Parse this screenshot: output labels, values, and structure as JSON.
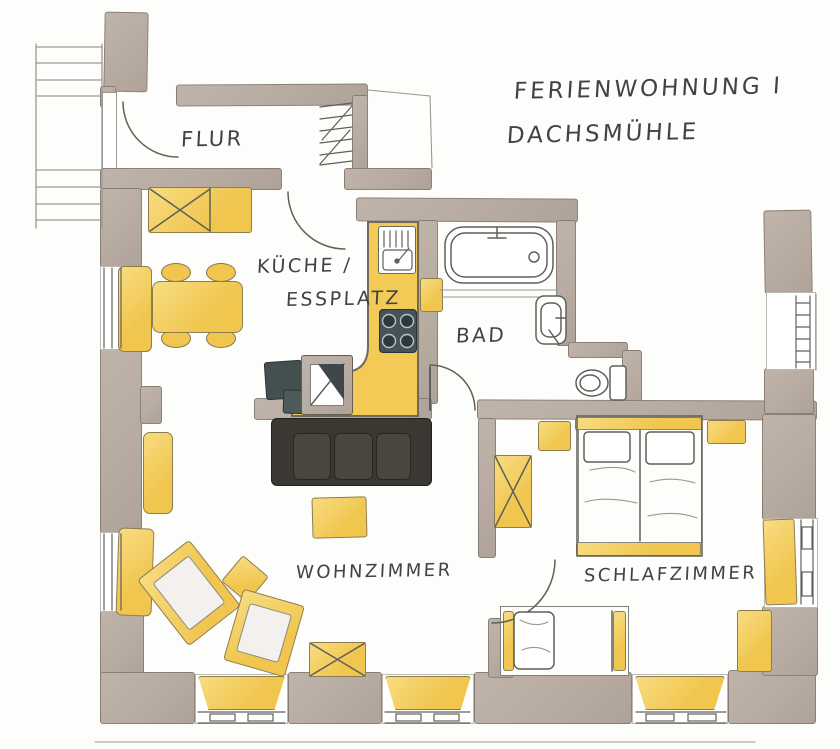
{
  "title": {
    "line1": "FERIENWOHNUNG I",
    "line2": "DACHSMÜHLE"
  },
  "rooms": {
    "flur": {
      "label": "FLUR"
    },
    "kueche": {
      "label_line1": "KÜCHE /",
      "label_line2": "ESSPLATZ"
    },
    "bad": {
      "label": "BAD"
    },
    "wohnzimmer": {
      "label": "WOHNZIMMER"
    },
    "schlafzimmer": {
      "label": "SCHLAFZIMMER"
    }
  },
  "legend_items": [],
  "furniture_names": [
    "hall-wardrobe",
    "dining-bench",
    "dining-table",
    "dining-chairs",
    "kitchen-counter",
    "kitchen-sink",
    "stove",
    "chimney",
    "tv-unit",
    "sofa",
    "coffee-table",
    "armchairs",
    "side-table",
    "cross-table",
    "double-bed",
    "single-bed",
    "bedroom-wardrobe",
    "nightstands",
    "bathtub",
    "washbasin",
    "toilet",
    "radiators",
    "windows",
    "stairs"
  ],
  "colors": {
    "paper": "#fdfdfb",
    "wall": "#b8aba1",
    "wall_edge": "#6e645b",
    "pencil": "#60605a",
    "pencil_light": "#9b988f",
    "yellow": "#f0c64f",
    "yellow_light": "#f8dc82",
    "sofa_dark": "#3b3833",
    "sofa_cushion": "#4a453d",
    "appliance_dark": "#43504f",
    "ink": "#3f4347"
  }
}
